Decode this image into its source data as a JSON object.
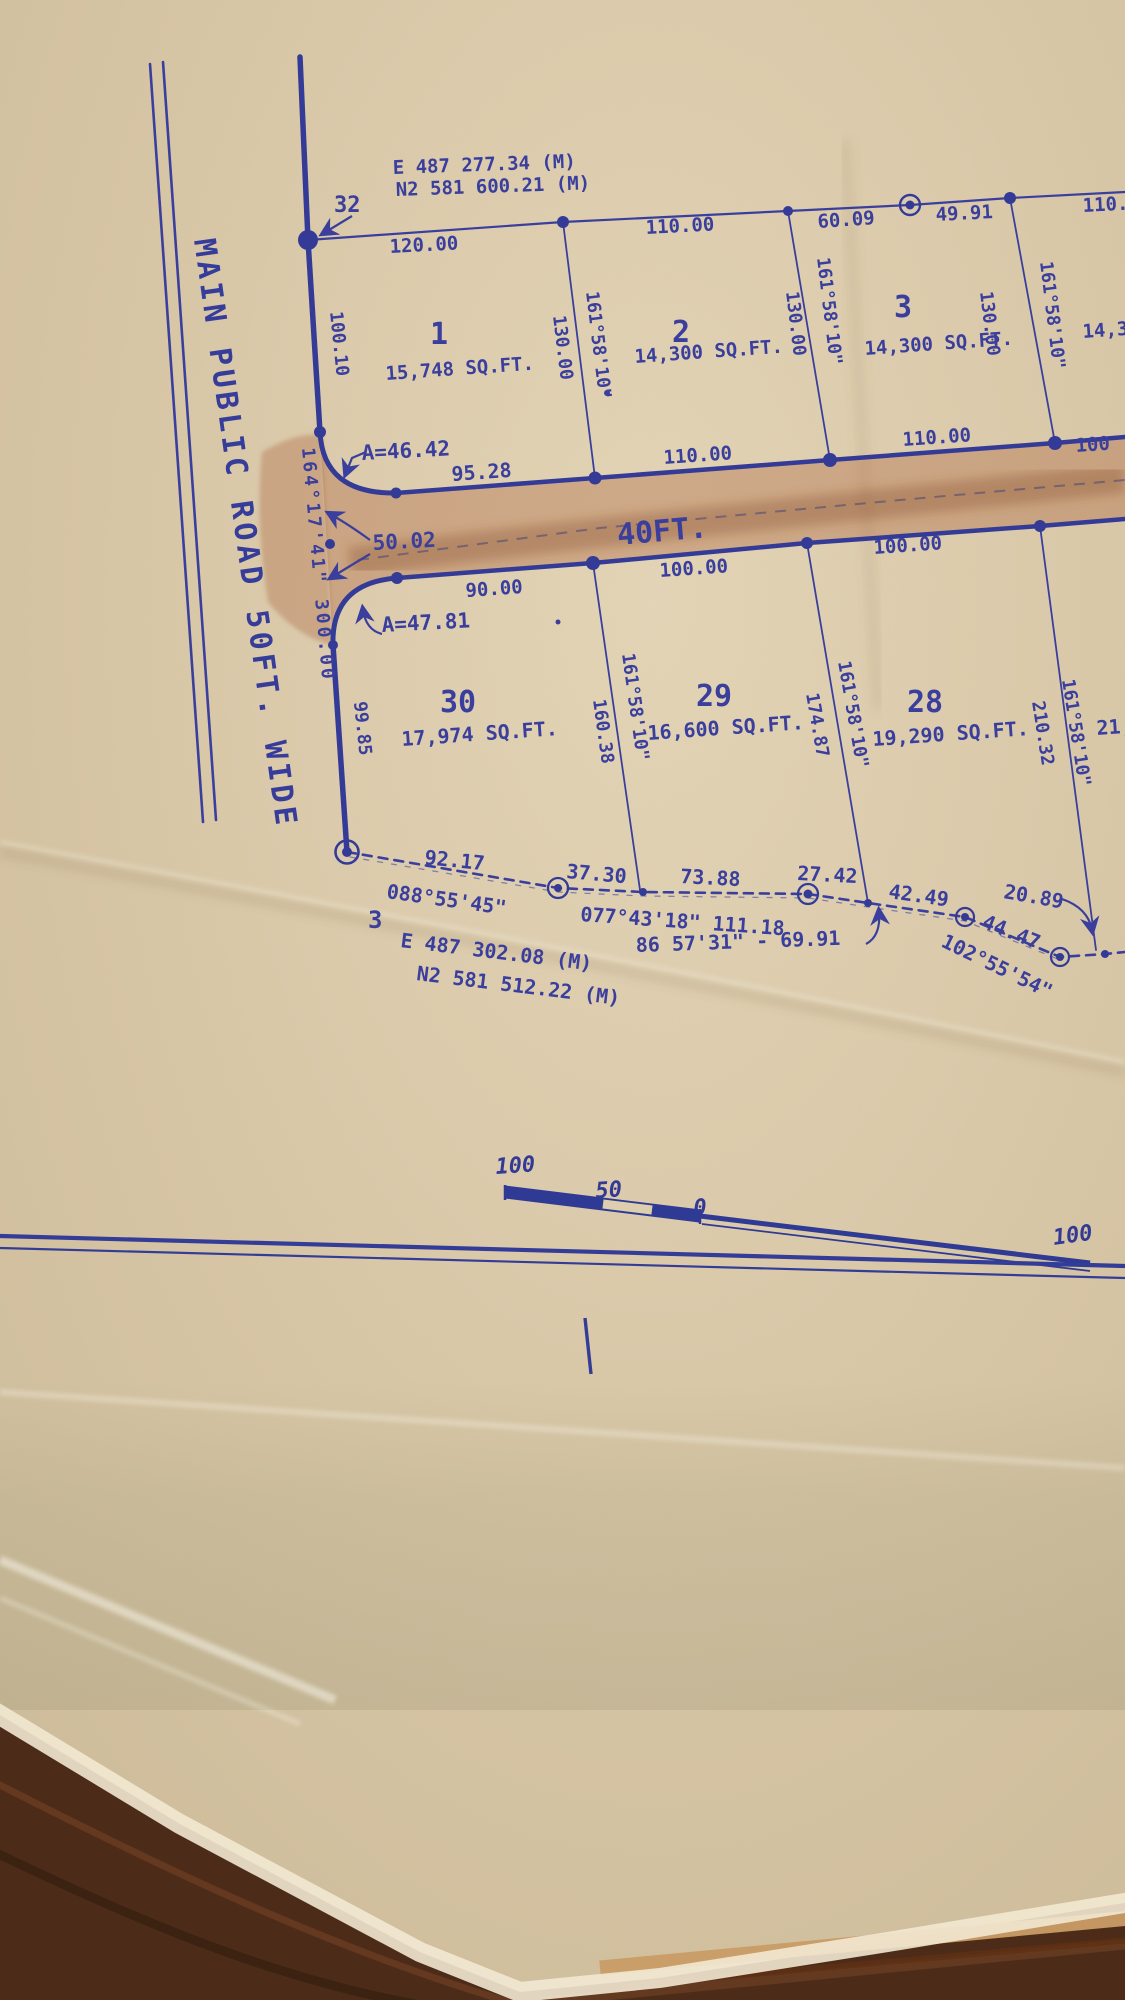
{
  "photo": {
    "corners": {
      "pt32": {
        "label": "32",
        "easting": "E  487 277.34 (M)",
        "northing": "N2 581 600.21 (M)"
      },
      "pt3": {
        "label": "3",
        "easting": "E  487 302.08 (M)",
        "northing": "N2 581 512.22 (M)"
      }
    },
    "roads": {
      "main_label": "MAIN PUBLIC ROAD 50FT. WIDE",
      "cross_label": "40FT.",
      "west_bearing": "164°17'41\" 300.00"
    },
    "north_lots": {
      "side_length": "130.00",
      "side_bearing": "161°58'10\"",
      "lot1": {
        "num": "1",
        "area": "15,748 SQ.FT.",
        "front": "120.00",
        "west_side": "100.10",
        "rear": "95.28"
      },
      "lot2": {
        "num": "2",
        "area": "14,300 SQ.FT.",
        "front": "110.00",
        "rear": "110.00"
      },
      "lot3": {
        "num": "3",
        "area": "14,300 SQ.FT.",
        "front_a": "60.09",
        "front_b": "49.91",
        "rear": "110.00"
      },
      "lot4": {
        "front_partial": "110.",
        "area_partial": "14,3",
        "rear_partial": "100"
      }
    },
    "south_lots": {
      "side_bearing": "161°58'10\"",
      "lot30": {
        "num": "30",
        "area": "17,974 SQ.FT.",
        "front": "90.00",
        "west_side": "99.85",
        "arc": "A=47.81"
      },
      "lot29": {
        "num": "29",
        "area": "16,600 SQ.FT.",
        "front": "100.00",
        "west_side": "160.38"
      },
      "lot28": {
        "num": "28",
        "area": "19,290 SQ.FT.",
        "front": "100.00",
        "west_side": "174.87"
      },
      "lot27": {
        "area_partial": "21,",
        "west_side": "210.32"
      }
    },
    "road_labels": {
      "arc_a": "A=46.42",
      "throat": "50.02"
    },
    "chain": {
      "d_9217": "92.17",
      "brg_088": "088°55'45\"",
      "d_3730": "37.30",
      "d_7388": "73.88",
      "brg_077": "077°43'18\" 111.18",
      "d_2742": "27.42",
      "d_4249": "42.49",
      "d_2089": "20.89",
      "d_4447": "44.47",
      "brg_102": "102°55'54\"",
      "note_86": "86 57'31\" - 69.91"
    },
    "scale_bar": {
      "left_100": "100",
      "mid_50": "50",
      "zero": "0",
      "right_100": "100"
    }
  }
}
